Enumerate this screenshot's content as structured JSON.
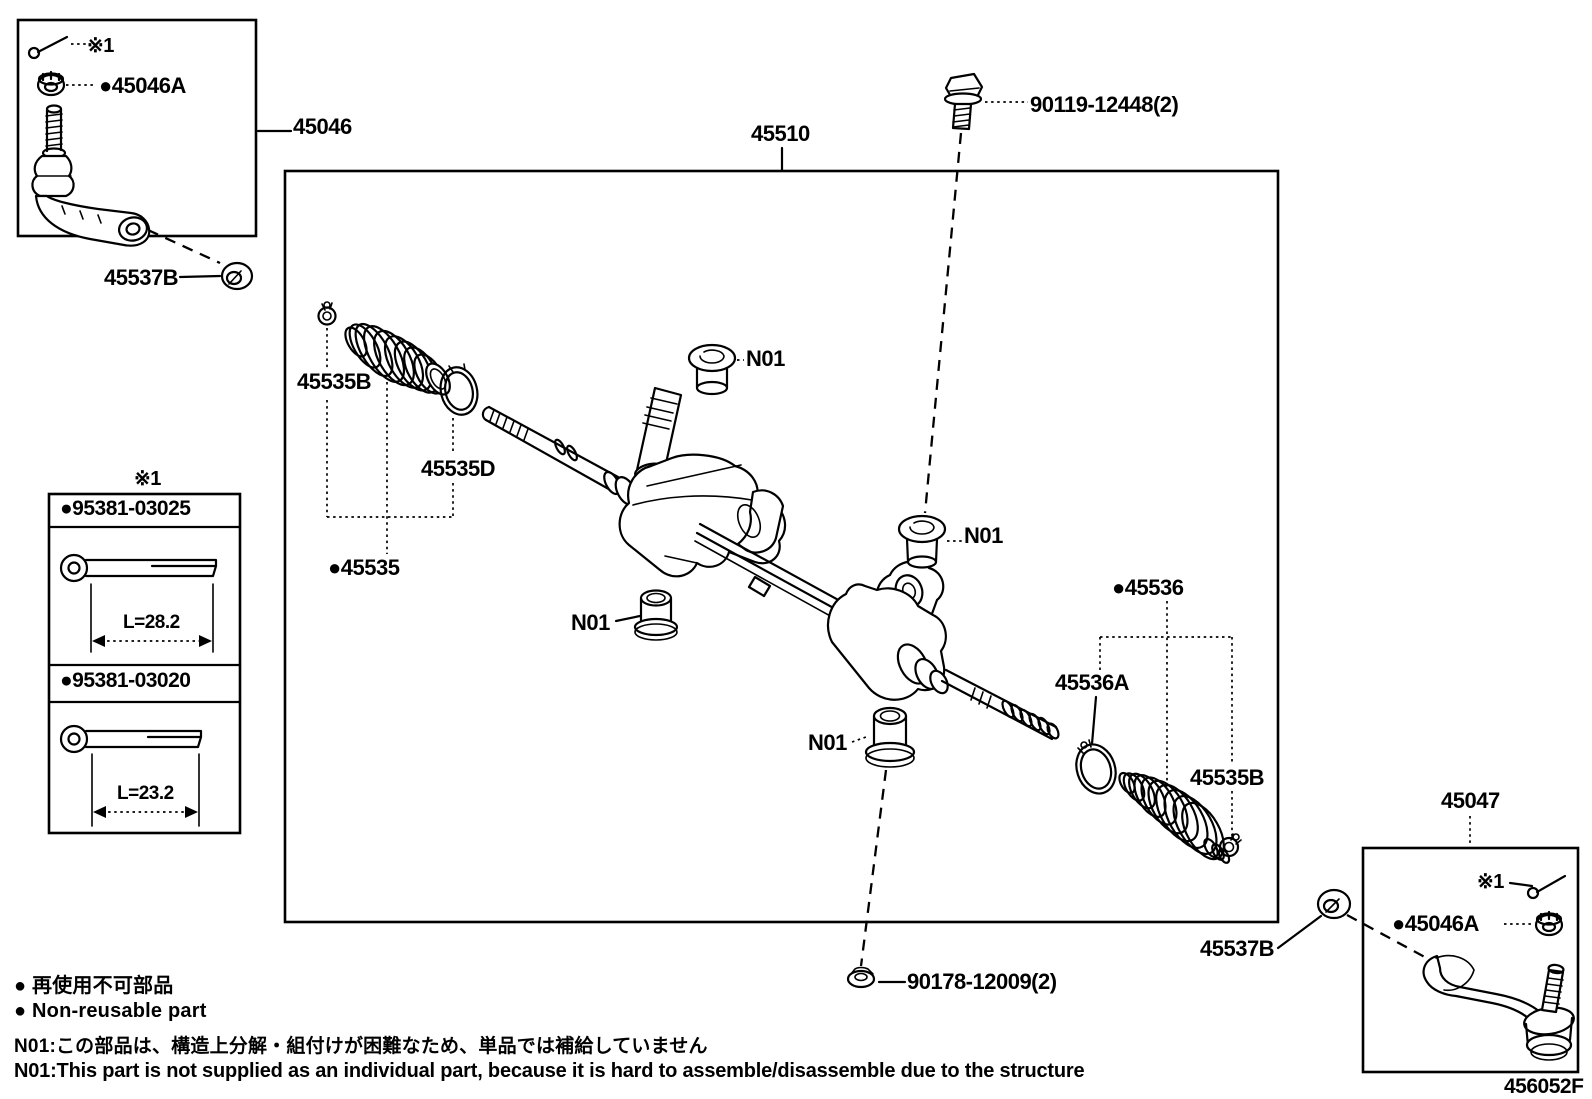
{
  "page": {
    "background": "#ffffff",
    "line_color": "#000000",
    "drawing_code": "456052F"
  },
  "callouts": {
    "gear_assembly": "45510",
    "tie_rod_outer_left": "45046",
    "tie_rod_outer_right": "45047",
    "castle_nut": "●45046A",
    "ref_mark": "※1",
    "lock_nut": "45537B",
    "bolt": "90119-12448(2)",
    "lower_nut": "90178-12009(2)",
    "boot_clamp_left": "45535B",
    "boot_ring_left": "45535D",
    "boot_kit_left": "●45535",
    "boot_kit_right": "●45536",
    "boot_clamp_large_right": "45536A",
    "boot_clamp_small_right": "45535B",
    "bushing": "N01"
  },
  "cotter_pin_table": {
    "ref_mark": "※1",
    "rows": [
      {
        "part_no": "●95381-03025",
        "length": "L=28.2"
      },
      {
        "part_no": "●95381-03020",
        "length": "L=23.2"
      }
    ]
  },
  "legend": {
    "jp": "● 再使用不可部品",
    "en": "● Non-reusable part"
  },
  "notes": {
    "jp": "N01:この部品は、構造上分解・組付けが困難なため、単品では補給していません",
    "en": "N01:This part is not supplied as an individual part, because it is hard to assemble/disassemble due to the structure"
  }
}
